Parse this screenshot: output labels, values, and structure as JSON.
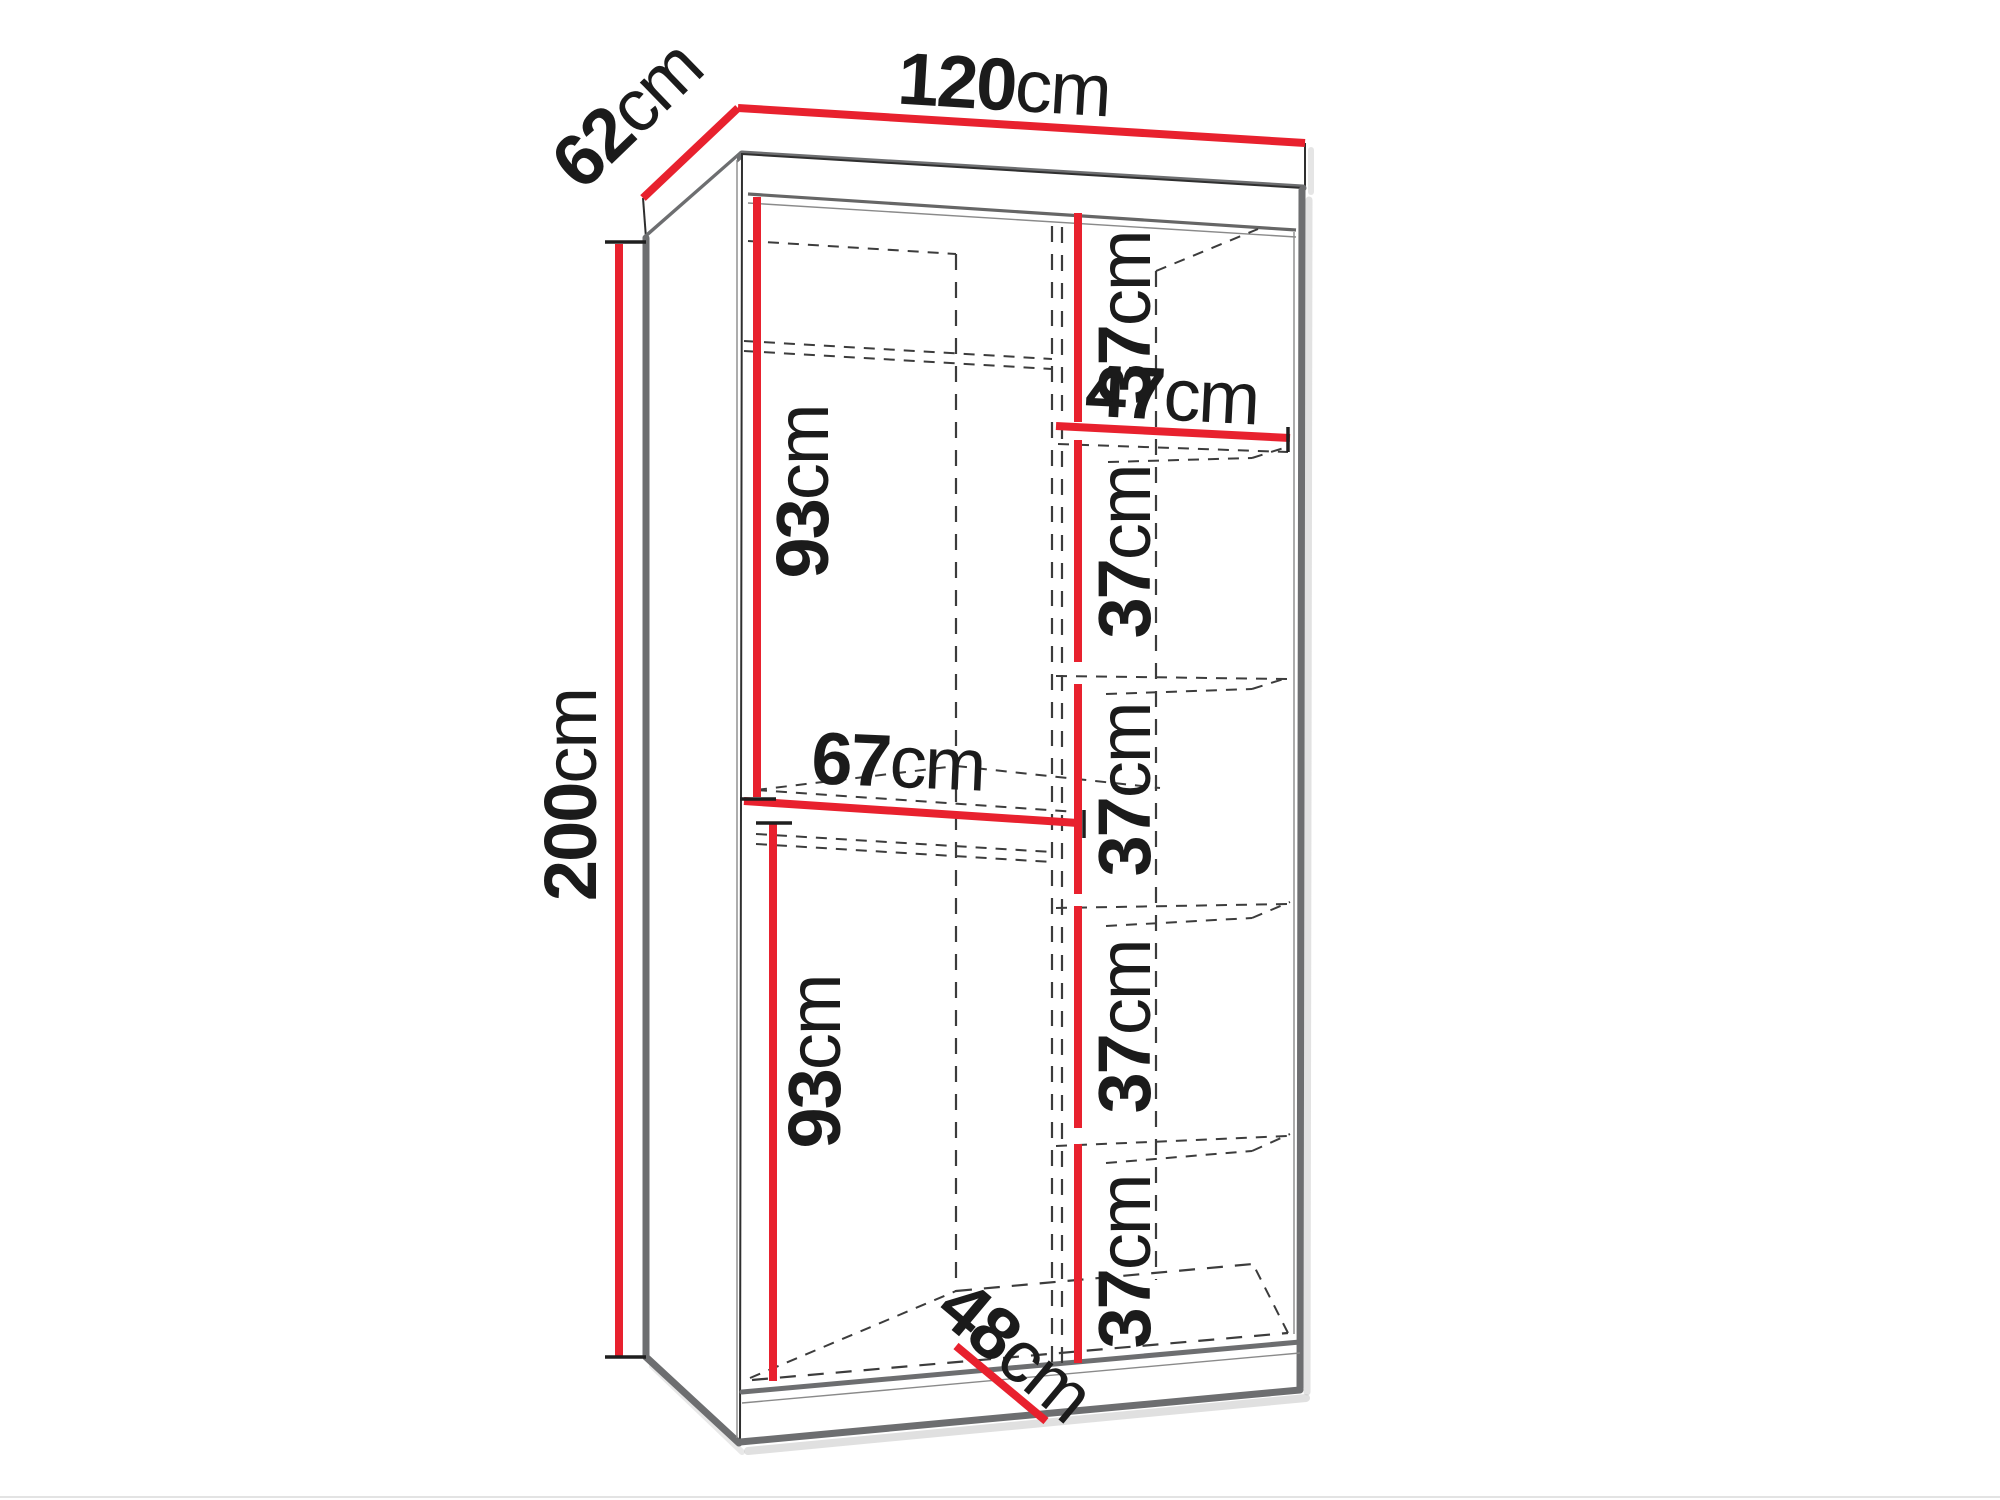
{
  "diagram": {
    "type": "furniture-dimension-drawing",
    "subject": "two-door wardrobe interior dimensions",
    "colors": {
      "background": "#ffffff",
      "dimension_red": "#e8212e",
      "outline_gray": "#6d6e70",
      "line_black": "#2f2f2f",
      "dash_gray": "#3c3c3c",
      "shadow_gray": "#c6c6c6"
    },
    "dimensions": {
      "width": {
        "value": "120",
        "unit": "cm"
      },
      "depth": {
        "value": "62",
        "unit": "cm"
      },
      "height": {
        "value": "200",
        "unit": "cm"
      },
      "upper_hanging_height": {
        "value": "93",
        "unit": "cm"
      },
      "left_compartment_width": {
        "value": "67",
        "unit": "cm"
      },
      "lower_hanging_height": {
        "value": "93",
        "unit": "cm"
      },
      "interior_depth": {
        "value": "48",
        "unit": "cm"
      },
      "shelf_width": {
        "value": "47",
        "unit": "cm"
      },
      "shelf_spacing": [
        {
          "value": "37",
          "unit": "cm"
        },
        {
          "value": "37",
          "unit": "cm"
        },
        {
          "value": "37",
          "unit": "cm"
        },
        {
          "value": "37",
          "unit": "cm"
        },
        {
          "value": "37",
          "unit": "cm"
        }
      ]
    }
  }
}
